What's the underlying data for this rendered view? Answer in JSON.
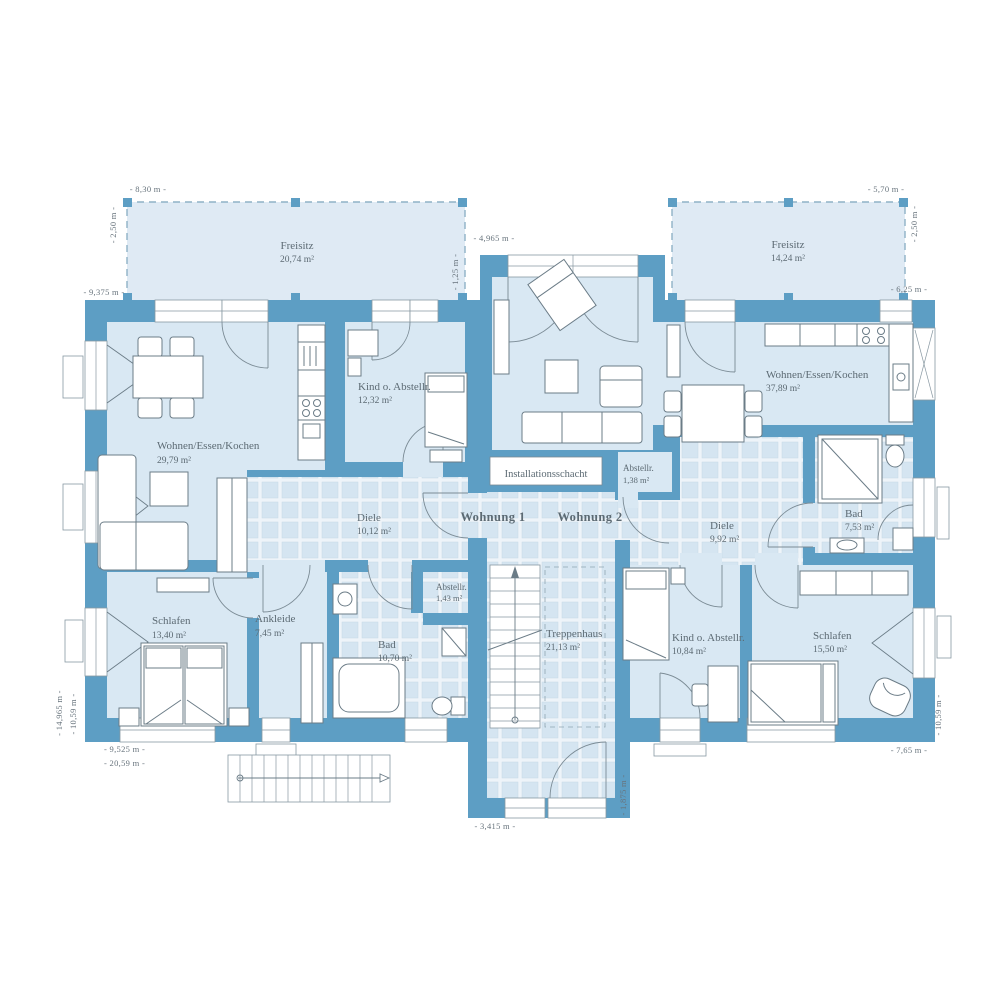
{
  "title": "Two-apartment floor plan (Obergeschoss)",
  "colors": {
    "wall": "#5d9ec4",
    "room_fill": "#d9e8f3",
    "tile_fill": "#d5e5f1",
    "tile_grout": "#eef4f9",
    "freisitz_fill": "#dfeaf4",
    "dash_line": "#8fb2c6",
    "furniture_line": "#6b7c87",
    "text": "#5c6a73"
  },
  "apartments": {
    "w1": "Wohnung 1",
    "w2": "Wohnung 2"
  },
  "shaft_label": "Installationsschacht",
  "rooms": [
    {
      "id": "freisitz-left",
      "name": "Freisitz",
      "area": "20,74 m²"
    },
    {
      "id": "freisitz-right",
      "name": "Freisitz",
      "area": "14,24 m²"
    },
    {
      "id": "w1-wohnen-essen-kochen",
      "name": "Wohnen/Essen/Kochen",
      "area": "29,79 m²"
    },
    {
      "id": "w1-kind-abstellraum",
      "name": "Kind o. Abstellr.",
      "area": "12,32 m²"
    },
    {
      "id": "w1-diele",
      "name": "Diele",
      "area": "10,12 m²"
    },
    {
      "id": "w1-schlafen",
      "name": "Schlafen",
      "area": "13,40 m²"
    },
    {
      "id": "w1-ankleide",
      "name": "Ankleide",
      "area": "7,45 m²"
    },
    {
      "id": "w1-bad",
      "name": "Bad",
      "area": "10,70 m²"
    },
    {
      "id": "w1-abstellraum",
      "name": "Abstellr.",
      "area": "1,43 m²"
    },
    {
      "id": "treppenhaus",
      "name": "Treppenhaus",
      "area": "21,13 m²"
    },
    {
      "id": "w2-abstellraum",
      "name": "Abstellr.",
      "area": "1,38 m²"
    },
    {
      "id": "w2-wohnen-essen-kochen",
      "name": "Wohnen/Essen/Kochen",
      "area": "37,89 m²"
    },
    {
      "id": "w2-diele",
      "name": "Diele",
      "area": "9,92 m²"
    },
    {
      "id": "w2-bad",
      "name": "Bad",
      "area": "7,53 m²"
    },
    {
      "id": "w2-kind-abstellraum",
      "name": "Kind o. Abstellr.",
      "area": "10,84 m²"
    },
    {
      "id": "w2-schlafen",
      "name": "Schlafen",
      "area": "15,50 m²"
    }
  ],
  "dimensions": [
    {
      "id": "top-left-width",
      "label": "- 8,30 m -"
    },
    {
      "id": "top-left-depth",
      "label": "- 2,50 m -"
    },
    {
      "id": "left-upper-width",
      "label": "- 9,375 m -"
    },
    {
      "id": "top-center-width",
      "label": "- 4,965 m -"
    },
    {
      "id": "top-center-offset",
      "label": "- 1,25 m -"
    },
    {
      "id": "top-right-width",
      "label": "- 5,70 m -"
    },
    {
      "id": "top-right-depth",
      "label": "- 2,50 m -"
    },
    {
      "id": "right-upper-width",
      "label": "- 6,25 m -"
    },
    {
      "id": "left-total-height",
      "label": "- 14,965 m -"
    },
    {
      "id": "left-wing-height",
      "label": "- 10,59 m -"
    },
    {
      "id": "bottom-left-width",
      "label": "- 9,525 m -"
    },
    {
      "id": "bottom-total-width",
      "label": "- 20,59 m -"
    },
    {
      "id": "bottom-entrance-width",
      "label": "- 3,415 m -"
    },
    {
      "id": "bottom-entrance-depth",
      "label": "- 1,875 m -"
    },
    {
      "id": "bottom-right-width",
      "label": "- 7,65 m -"
    },
    {
      "id": "right-wing-height",
      "label": "- 10,59 m -"
    }
  ]
}
